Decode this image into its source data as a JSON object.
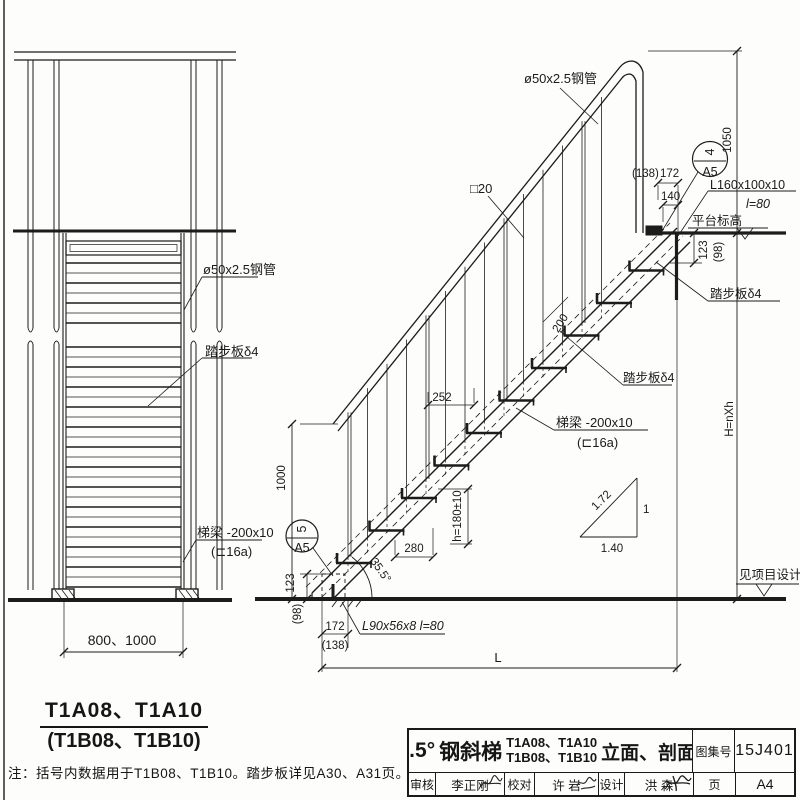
{
  "front": {
    "label_pipe": "ø50x2.5钢管",
    "label_tread": "踏步板δ4",
    "label_beam": "梯梁 -200x10",
    "label_beam_alt": "(⊏16a)",
    "dim_width": "800、1000",
    "title": "T1A08、T1A10",
    "title_alt": "(T1B08、T1B10)"
  },
  "section": {
    "label_pipe": "ø50x2.5钢管",
    "label_baluster": "□20",
    "dim_138": "(138)",
    "dim_172": "172",
    "dim_140": "140",
    "detail_top_num": "4",
    "detail_top_page": "A5",
    "label_angle_top": "L160x100x10",
    "label_angle_top_len": "l=80",
    "label_platform_level": "平台标高",
    "dim_1050": "1050",
    "dim_123_top": "123",
    "dim_98_top": "(98)",
    "label_tread_top": "踏步板δ4",
    "label_tread_mid": "踏步板δ4",
    "label_beam": "梯梁 -200x10",
    "label_beam_alt": "(⊏16a)",
    "dim_252": "252",
    "dim_200": "200",
    "dim_1000": "1000",
    "dim_280": "280",
    "dim_h": "h=180±10",
    "dim_angle": "35.5°",
    "slope_hyp": "1.72",
    "slope_rise": "1",
    "slope_run": "1.40",
    "detail_bot_num": "5",
    "detail_bot_page": "A5",
    "dim_123_bot": "123",
    "dim_98_bot": "(98)",
    "dim_172_bot": "172",
    "dim_138_bot": "(138)",
    "label_angle_bot": "L90x56x8  l=80",
    "dim_L": "L",
    "dim_H": "H=nXh",
    "label_project_level": "见项目设计"
  },
  "note": "注：括号内数据用于T1B08、T1B10。踏步板详见A30、A31页。",
  "titleblock": {
    "angle": "35.5°",
    "name": "钢斜梯",
    "models_a": "T1A08、T1A10",
    "models_b": "T1B08、T1B10",
    "suffix": "立面、剖面图",
    "atlas_label": "图集号",
    "atlas_no": "15J401",
    "audit_label": "审核",
    "audit_name": "李正刚",
    "check_label": "校对",
    "check_name": "许 岩",
    "design_label": "设计",
    "design_name": "洪 森",
    "page_label": "页",
    "page_no": "A4"
  }
}
